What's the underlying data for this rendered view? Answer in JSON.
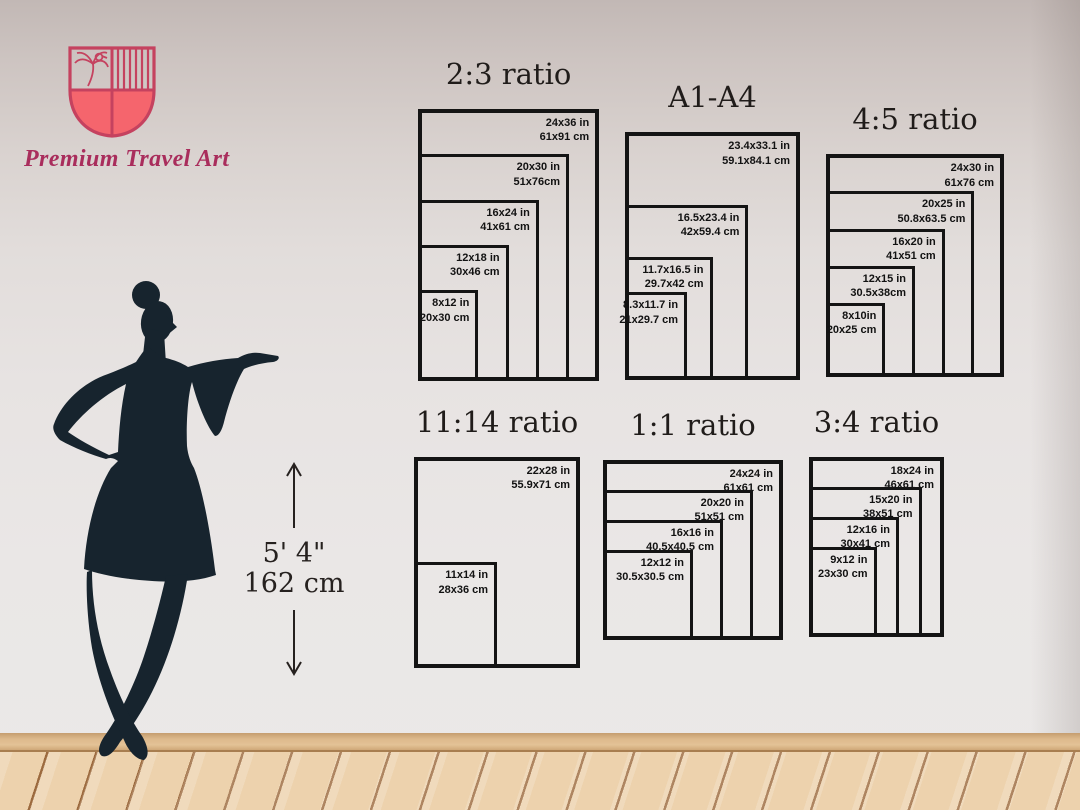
{
  "brand": {
    "name": "Premium Travel Art",
    "logo_outline_color": "#c5425f",
    "logo_fill_color": "#f5656d",
    "logo_text_color": "#a92d5c",
    "logo_emblem": "palm-and-bird shield crest"
  },
  "height_marker": {
    "imperial": "5' 4\"",
    "metric": "162 cm"
  },
  "colors": {
    "frame_border": "#141414",
    "silhouette": "#17242e",
    "wall_light": "#e7e3e2",
    "floor_wood": "#edd2ad"
  },
  "chart_data": {
    "type": "table",
    "title": "Poster print size comparison guide",
    "groups": [
      {
        "title": "2:3 ratio",
        "sizes": [
          {
            "label_in": "24x36 in",
            "label_cm": "61x91 cm",
            "width_in": 24,
            "height_in": 36
          },
          {
            "label_in": "20x30 in",
            "label_cm": "51x76cm",
            "width_in": 20,
            "height_in": 30
          },
          {
            "label_in": "16x24 in",
            "label_cm": "41x61 cm",
            "width_in": 16,
            "height_in": 24
          },
          {
            "label_in": "12x18 in",
            "label_cm": "30x46 cm",
            "width_in": 12,
            "height_in": 18
          },
          {
            "label_in": "8x12 in",
            "label_cm": "20x30 cm",
            "width_in": 8,
            "height_in": 12
          }
        ]
      },
      {
        "title": "A1-A4",
        "sizes": [
          {
            "label_in": "23.4x33.1 in",
            "label_cm": "59.1x84.1 cm",
            "width_in": 23.4,
            "height_in": 33.1
          },
          {
            "label_in": "16.5x23.4 in",
            "label_cm": "42x59.4 cm",
            "width_in": 16.5,
            "height_in": 23.4
          },
          {
            "label_in": "11.7x16.5 in",
            "label_cm": "29.7x42 cm",
            "width_in": 11.7,
            "height_in": 16.5
          },
          {
            "label_in": "8.3x11.7 in",
            "label_cm": "21x29.7 cm",
            "width_in": 8.3,
            "height_in": 11.7
          }
        ]
      },
      {
        "title": "4:5 ratio",
        "sizes": [
          {
            "label_in": "24x30 in",
            "label_cm": "61x76 cm",
            "width_in": 24,
            "height_in": 30
          },
          {
            "label_in": "20x25 in",
            "label_cm": "50.8x63.5 cm",
            "width_in": 20,
            "height_in": 25
          },
          {
            "label_in": "16x20 in",
            "label_cm": "41x51 cm",
            "width_in": 16,
            "height_in": 20
          },
          {
            "label_in": "12x15 in",
            "label_cm": "30.5x38cm",
            "width_in": 12,
            "height_in": 15
          },
          {
            "label_in": "8x10in",
            "label_cm": "20x25 cm",
            "width_in": 8,
            "height_in": 10
          }
        ]
      },
      {
        "title": "11:14 ratio",
        "sizes": [
          {
            "label_in": "22x28 in",
            "label_cm": "55.9x71 cm",
            "width_in": 22,
            "height_in": 28
          },
          {
            "label_in": "11x14 in",
            "label_cm": "28x36 cm",
            "width_in": 11,
            "height_in": 14
          }
        ]
      },
      {
        "title": "1:1 ratio",
        "sizes": [
          {
            "label_in": "24x24 in",
            "label_cm": "61x61 cm",
            "width_in": 24,
            "height_in": 24
          },
          {
            "label_in": "20x20 in",
            "label_cm": "51x51 cm",
            "width_in": 20,
            "height_in": 20
          },
          {
            "label_in": "16x16 in",
            "label_cm": "40.5x40.5 cm",
            "width_in": 16,
            "height_in": 16
          },
          {
            "label_in": "12x12 in",
            "label_cm": "30.5x30.5 cm",
            "width_in": 12,
            "height_in": 12
          }
        ]
      },
      {
        "title": "3:4 ratio",
        "sizes": [
          {
            "label_in": "18x24 in",
            "label_cm": "46x61 cm",
            "width_in": 18,
            "height_in": 24
          },
          {
            "label_in": "15x20 in",
            "label_cm": "38x51 cm",
            "width_in": 15,
            "height_in": 20
          },
          {
            "label_in": "12x16 in",
            "label_cm": "30x41 cm",
            "width_in": 12,
            "height_in": 16
          },
          {
            "label_in": "9x12 in",
            "label_cm": "23x30 cm",
            "width_in": 9,
            "height_in": 12
          }
        ]
      }
    ]
  }
}
